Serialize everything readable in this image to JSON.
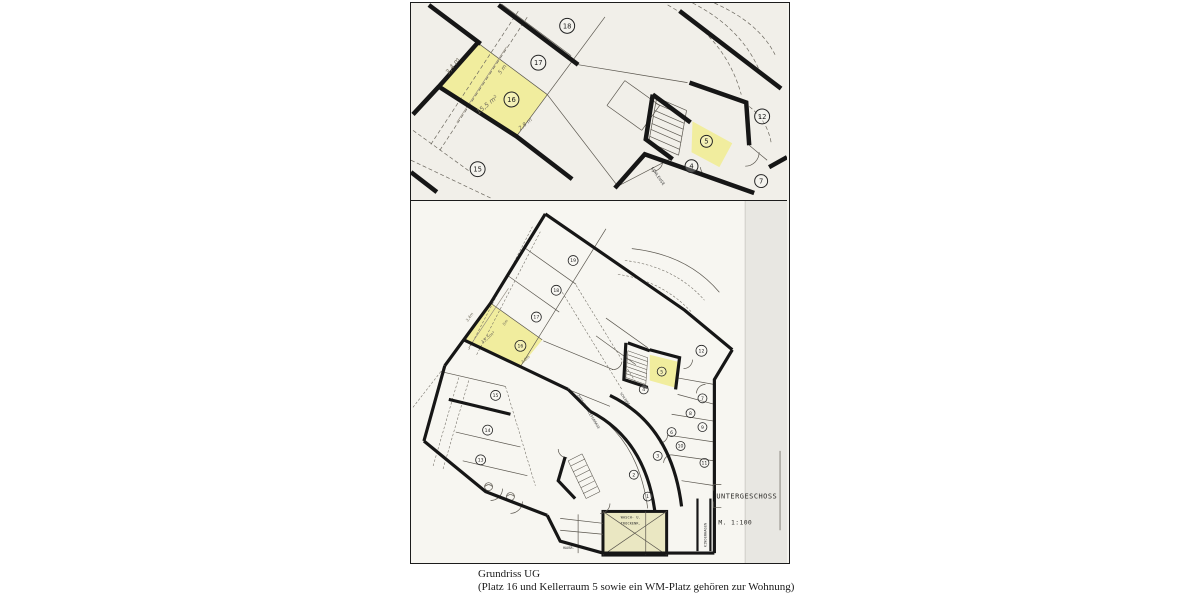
{
  "caption": {
    "line1": "Grundriss UG",
    "line2": "(Platz 16 und Kellerraum 5 sowie ein WM-Platz gehören zur Wohnung)"
  },
  "colors": {
    "highlight_yellow": "#f1ed9e",
    "wash_room_yellow": "#eae7c2",
    "paper_top": "#f1efe9",
    "paper_bottom": "#f7f6f1",
    "wall_ink": "#161616"
  },
  "top_plan": {
    "rooms": [
      "18",
      "17",
      "16",
      "15",
      "12",
      "5",
      "4",
      "7"
    ],
    "dims": {
      "edge": "3,4 m",
      "mid": "5 m",
      "area": "15,5 m²",
      "bottom": "2,8 m"
    },
    "labels": {
      "schleuse": "SCHLEUSE"
    }
  },
  "bottom_plan": {
    "rooms": [
      "19",
      "18",
      "17",
      "16",
      "15",
      "14",
      "13",
      "12",
      "5",
      "4",
      "7",
      "8",
      "9",
      "6",
      "10",
      "3",
      "11",
      "2",
      "1"
    ],
    "dims": {
      "edge": "3,4m",
      "mid": "5m",
      "area": "15,5m²",
      "bottom": "2,8m"
    },
    "labels": {
      "untergeschoss": "UNTERGESCHOSS",
      "scale": "M. 1:100",
      "wash1": "WASCH- U.",
      "wash2": "TROCKENR.",
      "kinderwagen": "KINDERWAGEN",
      "schleuse": "SCHLEUSE",
      "zufahrt": "ZUFAHRT TIEFGARAGE",
      "hausr": "HAUSR."
    }
  }
}
